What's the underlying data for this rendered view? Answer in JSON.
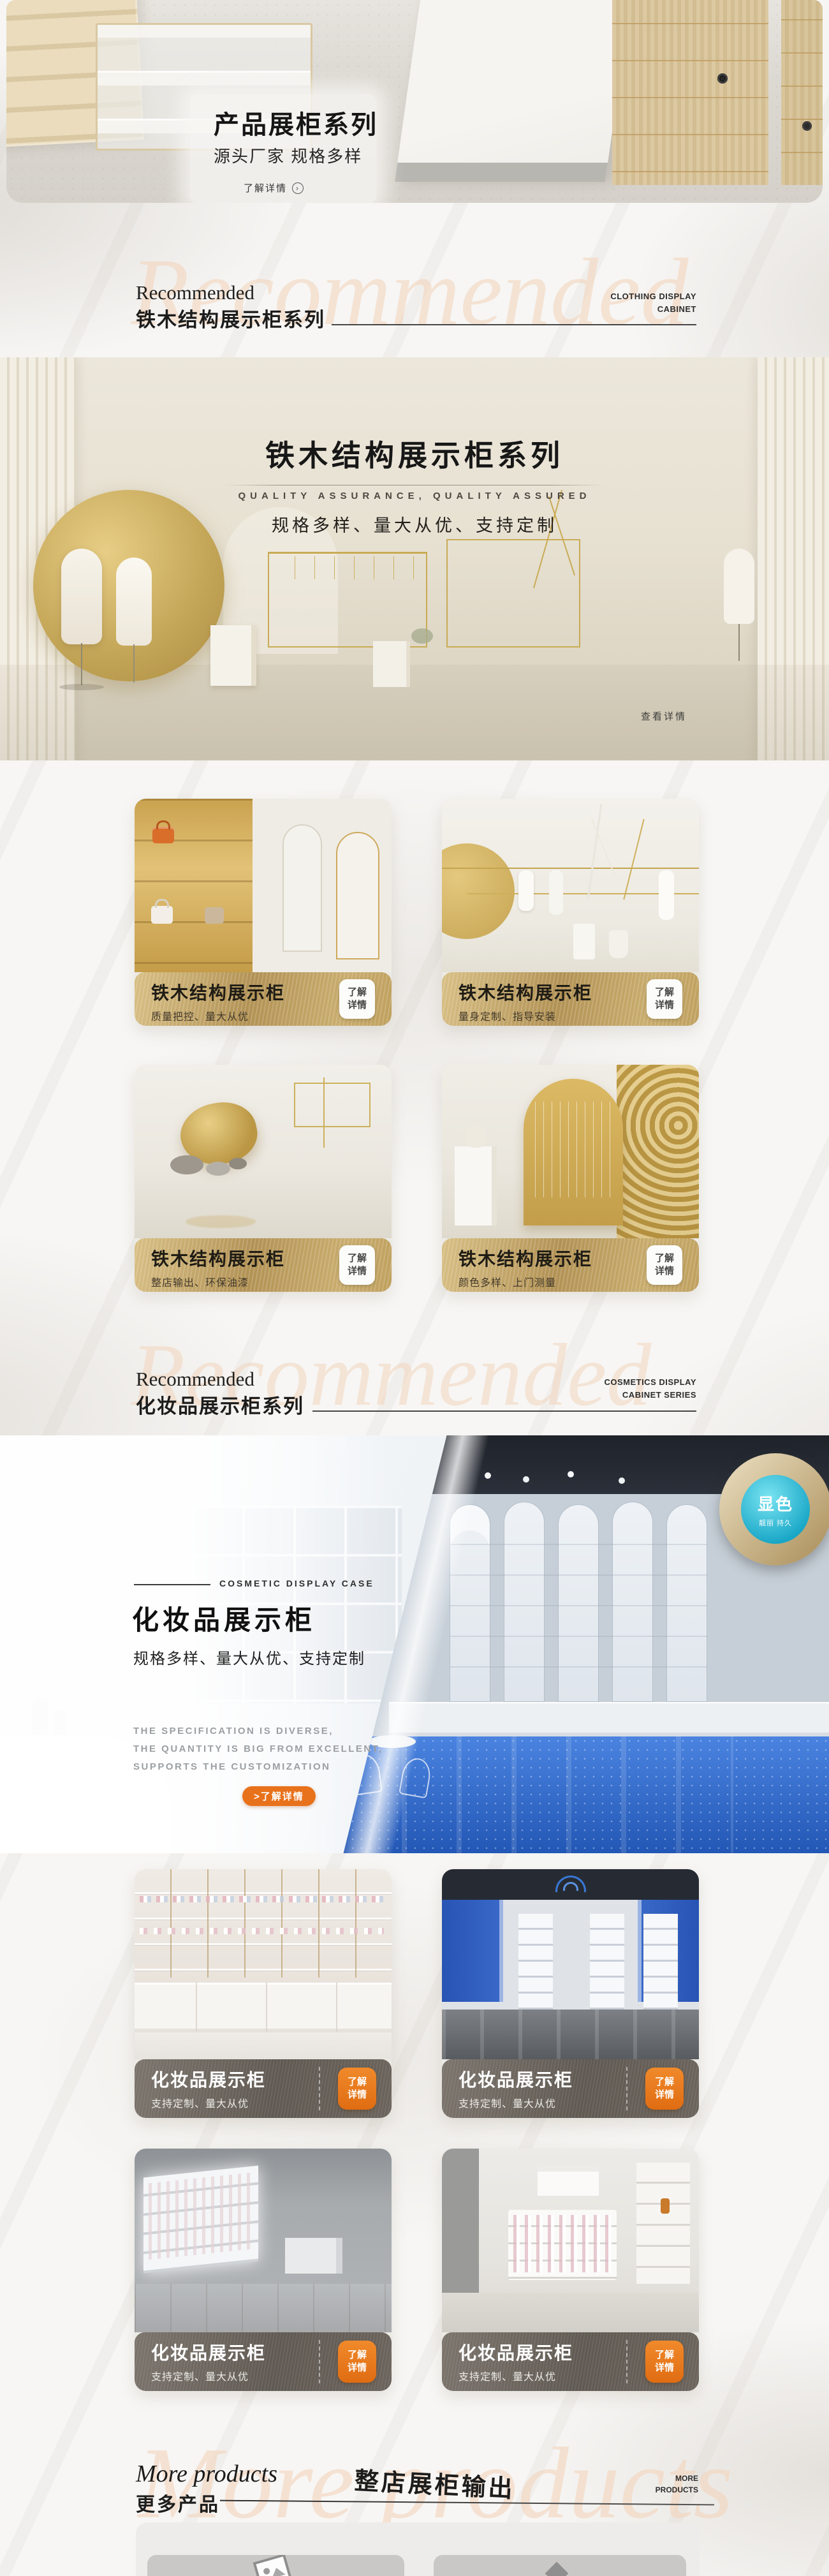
{
  "hero": {
    "title": "产品展柜系列",
    "subtitle": "源头厂家 规格多样",
    "link_label": "了解详情",
    "link_icon_glyph": "›"
  },
  "section1": {
    "eyebrow": "Recommended",
    "title": "铁木结构展示柜系列",
    "side_line1": "CLOTHING DISPLAY",
    "side_line2": "CABINET",
    "watermark": "Recommended"
  },
  "banner1": {
    "title": "铁木结构展示柜系列",
    "tagline_en": "QUALITY ASSURANCE, QUALITY ASSURED",
    "tagline_cn": "规格多样、量大从优、支持定制",
    "detail_link": "查看详情"
  },
  "grid1": {
    "cards": [
      {
        "title": "铁木结构展示柜",
        "subtitle": "质量把控、量大从优",
        "button_line1": "了解",
        "button_line2": "详情"
      },
      {
        "title": "铁木结构展示柜",
        "subtitle": "量身定制、指导安装",
        "button_line1": "了解",
        "button_line2": "详情"
      },
      {
        "title": "铁木结构展示柜",
        "subtitle": "整店输出、环保油漆",
        "button_line1": "了解",
        "button_line2": "详情"
      },
      {
        "title": "铁木结构展示柜",
        "subtitle": "颜色多样、上门测量",
        "button_line1": "了解",
        "button_line2": "详情"
      }
    ]
  },
  "section2": {
    "eyebrow": "Recommended",
    "title": "化妆品展示柜系列",
    "side_line1": "COSMETICS DISPLAY",
    "side_line2": "CABINET SERIES",
    "watermark": "Recommended"
  },
  "banner2": {
    "eyebrow": "COSMETIC DISPLAY CASE",
    "title": "化妆品展示柜",
    "tagline_cn": "规格多样、量大从优、支持定制",
    "tagline_en_line1": "THE SPECIFICATION IS DIVERSE,",
    "tagline_en_line2": "THE QUANTITY IS BIG FROM EXCELLENT,",
    "tagline_en_line3": "SUPPORTS THE CUSTOMIZATION",
    "button_label": ">了解详情",
    "badge_title": "显色",
    "badge_subtitle": "靓丽 持久"
  },
  "grid2": {
    "cards": [
      {
        "title": "化妆品展示柜",
        "subtitle": "支持定制、量大从优",
        "button_line1": "了解",
        "button_line2": "详情"
      },
      {
        "title": "化妆品展示柜",
        "subtitle": "支持定制、量大从优",
        "button_line1": "了解",
        "button_line2": "详情"
      },
      {
        "title": "化妆品展示柜",
        "subtitle": "支持定制、量大从优",
        "button_line1": "了解",
        "button_line2": "详情"
      },
      {
        "title": "化妆品展示柜",
        "subtitle": "支持定制、量大从优",
        "button_line1": "了解",
        "button_line2": "详情"
      }
    ]
  },
  "more": {
    "eyebrow": "More products",
    "title": "更多产品",
    "center_title": "整店展柜输出",
    "side_line1": "MORE",
    "side_line2": "PRODUCTS",
    "watermark": "More products"
  },
  "colors": {
    "accent_orange": "#e8721c",
    "gold_bar": "#b89a5e",
    "dark_bar": "#65605a",
    "banner2_floor_blue": "#2b63c6",
    "badge_cyan": "#2cc2d8",
    "watermark_peach": "#f2d5c0"
  }
}
